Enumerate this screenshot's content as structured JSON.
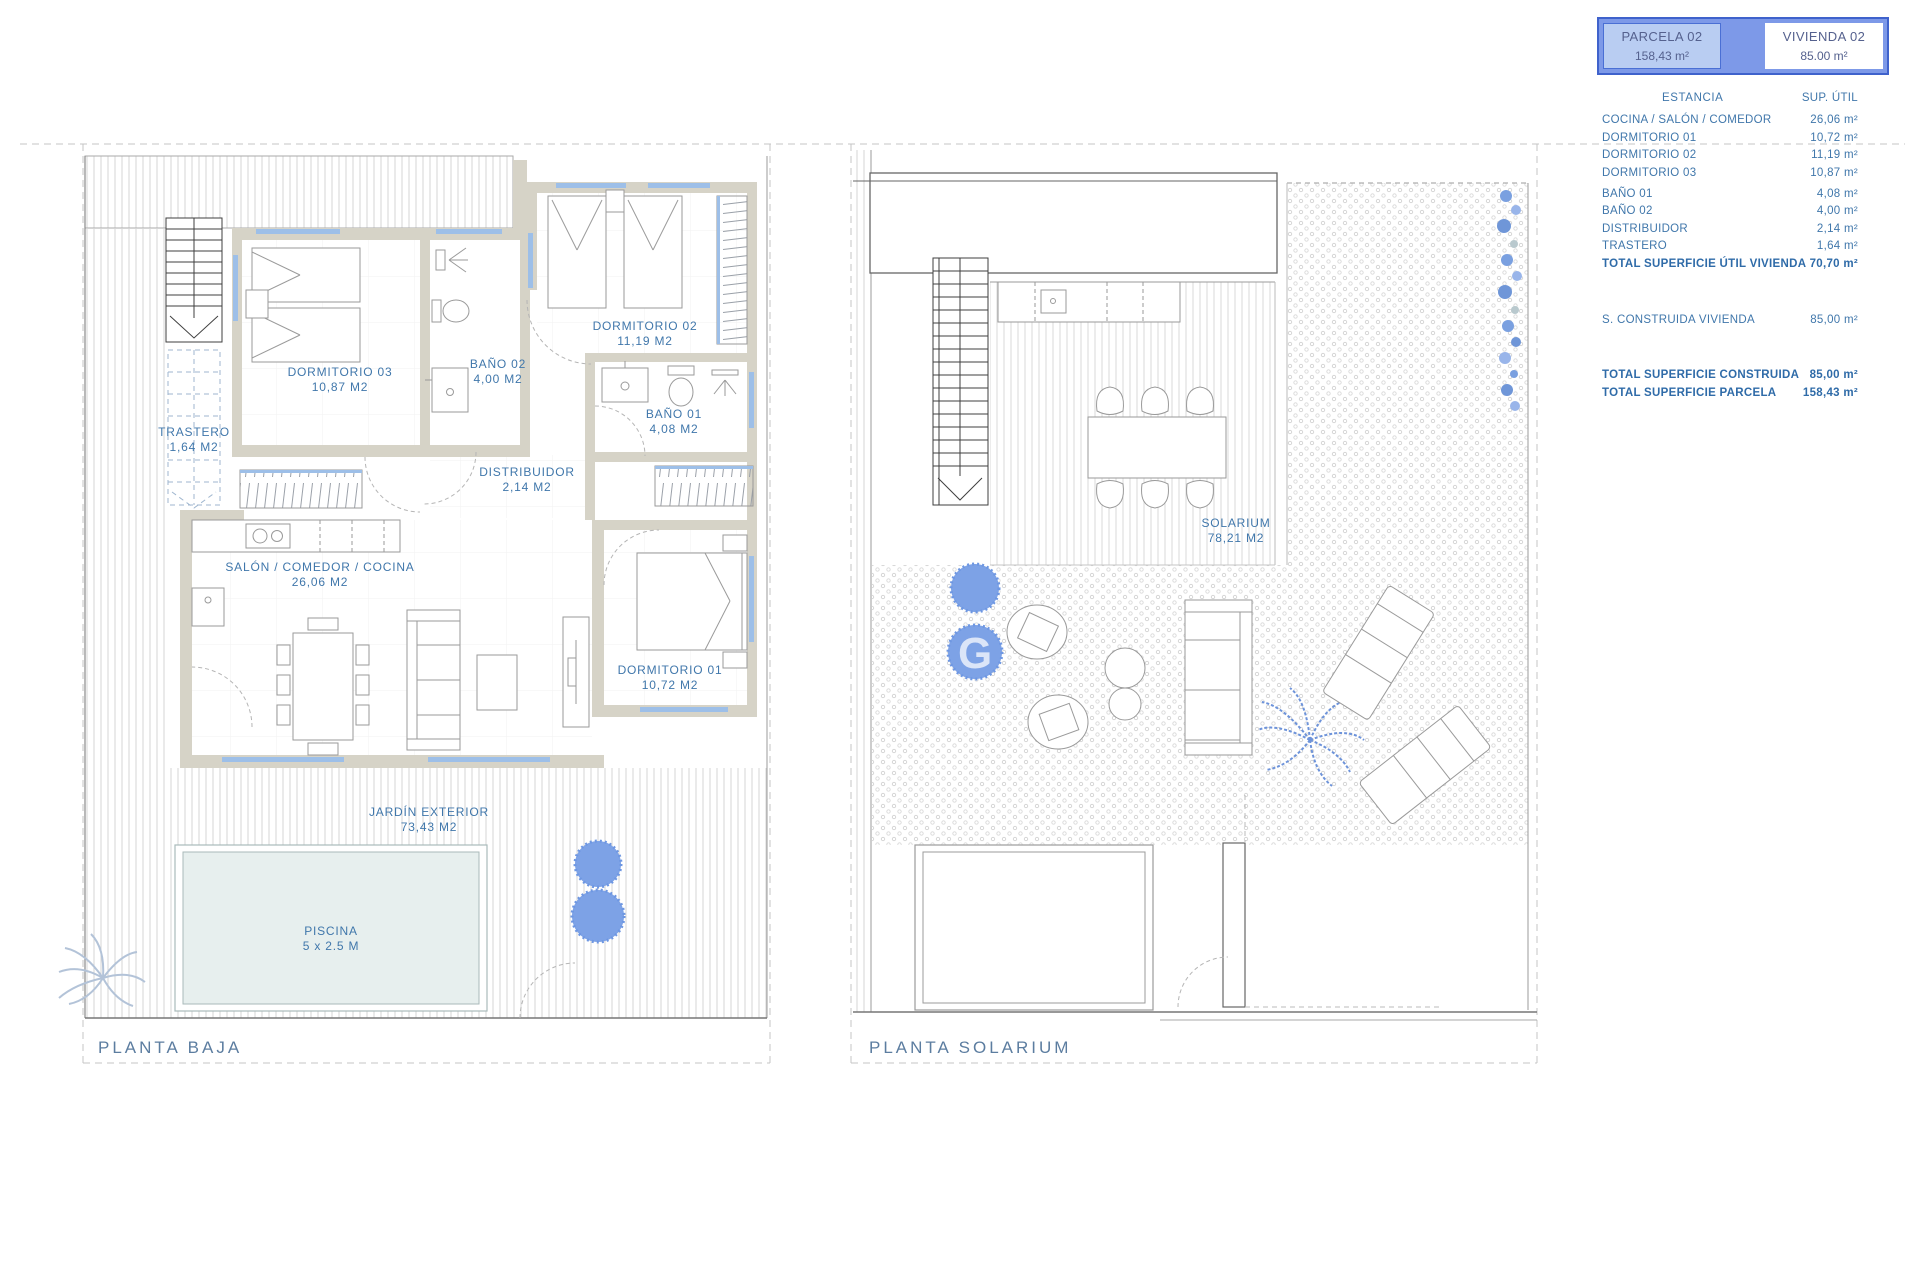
{
  "colors": {
    "label_blue": "#4077ab",
    "title_blue": "#5c7da0",
    "legend_border": "#3f62cc",
    "legend_fill": "#7d99e8",
    "legend_cell_blue": "#b9cdf2",
    "legend_text": "#55618e",
    "wall_fill": "#d6d3c7",
    "window_blue": "#9dbfe8",
    "bush_blue": "#7da2e6",
    "pool_fill": "#e7efee"
  },
  "legend": {
    "parcela": {
      "title": "PARCELA 02",
      "area": "158,43 m²"
    },
    "vivienda": {
      "title": "VIVIENDA 02",
      "area": "85.00 m²"
    },
    "table": {
      "header": {
        "estancia": "ESTANCIA",
        "sup": "SUP. ÚTIL"
      },
      "rows": [
        {
          "label": "COCINA / SALÓN / COMEDOR",
          "value": "26,06 m²"
        },
        {
          "label": "DORMITORIO 01",
          "value": "10,72 m²"
        },
        {
          "label": "DORMITORIO 02",
          "value": "11,19 m²"
        },
        {
          "label": "DORMITORIO 03",
          "value": "10,87 m²"
        },
        {
          "label": "BAÑO 01",
          "value": "4,08 m²"
        },
        {
          "label": "BAÑO 02",
          "value": "4,00 m²"
        },
        {
          "label": "DISTRIBUIDOR",
          "value": "2,14 m²"
        },
        {
          "label": "TRASTERO",
          "value": "1,64 m²"
        }
      ],
      "total_util": {
        "label": "TOTAL SUPERFICIE ÚTIL VIVIENDA",
        "value": "70,70 m²"
      },
      "construida": {
        "label": "S. CONSTRUIDA VIVIENDA",
        "value": "85,00 m²"
      },
      "total_construida": {
        "label": "TOTAL SUPERFICIE CONSTRUIDA",
        "value": "85,00 m²"
      },
      "total_parcela": {
        "label": "TOTAL SUPERFICIE PARCELA",
        "value": "158,43 m²"
      }
    }
  },
  "plan_baja": {
    "title": "PLANTA BAJA",
    "rooms": {
      "trastero": {
        "name": "TRASTERO",
        "area": "1,64 M2"
      },
      "dormitorio03": {
        "name": "DORMITORIO 03",
        "area": "10,87 M2"
      },
      "bano02": {
        "name": "BAÑO 02",
        "area": "4,00 M2"
      },
      "dormitorio02": {
        "name": "DORMITORIO 02",
        "area": "11,19 M2"
      },
      "bano01": {
        "name": "BAÑO 01",
        "area": "4,08 M2"
      },
      "distribuidor": {
        "name": "DISTRIBUIDOR",
        "area": "2,14 M2"
      },
      "salon": {
        "name": "SALÓN / COMEDOR / COCINA",
        "area": "26,06 M2"
      },
      "dormitorio01": {
        "name": "DORMITORIO 01",
        "area": "10,72 M2"
      },
      "jardin": {
        "name": "JARDÍN EXTERIOR",
        "area": "73,43 M2"
      },
      "piscina": {
        "name": "PISCINA",
        "area": "5 x 2.5 M"
      }
    }
  },
  "plan_solarium": {
    "title": "PLANTA SOLARIUM",
    "rooms": {
      "solarium": {
        "name": "SOLARIUM",
        "area": "78,21 M2"
      }
    }
  },
  "watermark": "G"
}
